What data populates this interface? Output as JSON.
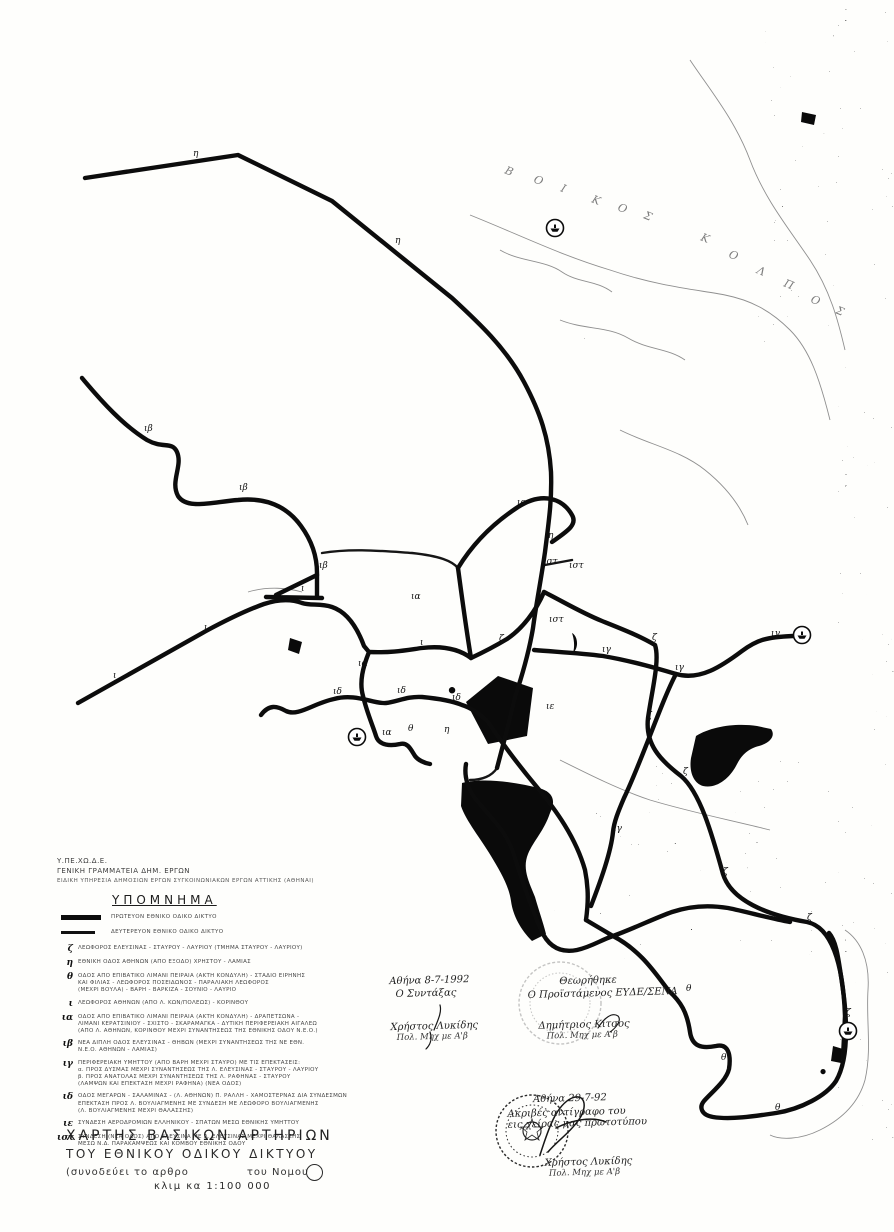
{
  "agency": {
    "line1": "Υ.ΠΕ.ΧΩ.Δ.Ε.",
    "line2": "ΓΕΝΙΚΗ ΓΡΑΜΜΑΤΕΙΑ ΔΗΜ. ΕΡΓΩΝ",
    "line3": "ΕΙΔΙΚΗ ΥΠΗΡΕΣΙΑ ΔΗΜΟΣΙΩΝ ΕΡΓΩΝ ΣΥΓΚΟΙΝΩΝΙΑΚΩΝ ΕΡΓΩΝ ΑΤΤΙΚΗΣ (ΑΘΗΝΑΙ)"
  },
  "legend": {
    "title": "ΥΠΟΜΝΗΜΑ",
    "line_items": [
      {
        "symbol": "thick-line",
        "label": "ΠΡΩΤΕΥΟΝ ΕΘΝΙΚΟ ΟΔΙΚΟ ΔΙΚΤΥΟ"
      },
      {
        "symbol": "medium-line",
        "label": "ΔΕΥΤΕΡΕΥΟΝ ΕΘΝΙΚΟ ΟΔΙΚΟ ΔΙΚΤΥΟ"
      }
    ],
    "entries": [
      {
        "key": "ζ",
        "lines": [
          "ΛΕΩΦΟΡΟΣ ΕΛΕΥΣΙΝΑΣ - ΣΤΑΥΡΟΥ - ΛΑΥΡΙΟΥ (ΤΜΗΜΑ ΣΤΑΥΡΟΥ - ΛΑΥΡΙΟΥ)"
        ]
      },
      {
        "key": "η",
        "lines": [
          "ΕΘΝΙΚΗ ΟΔΟΣ ΑΘΗΝΩΝ (ΑΠΟ ΕΞΟΔΟ) ΧΡΗΣΤΟΥ - ΛΑΜΙΑΣ"
        ]
      },
      {
        "key": "θ",
        "lines": [
          "ΟΔΟΣ ΑΠΟ ΕΠΙΒΑΤΙΚΟ ΛΙΜΑΝΙ ΠΕΙΡΑΙΑ (ΑΚΤΗ ΚΟΝΔΥΛΗ) - ΣΤΑΔΙΟ ΕΙΡΗΝΗΣ",
          "ΚΑΙ ΦΙΛΙΑΣ - ΛΕΩΦΟΡΟΣ ΠΟΣΕΙΔΩΝΟΣ - ΠΑΡΑΛΙΑΚΗ ΛΕΩΦΟΡΟΣ",
          "(ΜΕΧΡΙ ΒΟΥΛΑ) - ΒΑΡΗ - ΒΑΡΚΙΖΑ - ΣΟΥΝΙΟ - ΛΑΥΡΙΟ"
        ]
      },
      {
        "key": "ι",
        "lines": [
          "ΛΕΩΦΟΡΟΣ ΑΘΗΝΩΝ (ΑΠΟ Λ. ΚΩΝ/ΠΟΛΕΩΣ) - ΚΟΡΙΝΘΟΥ"
        ]
      },
      {
        "key": "ια",
        "lines": [
          "ΟΔΟΣ ΑΠΟ ΕΠΙΒΑΤΙΚΟ ΛΙΜΑΝΙ ΠΕΙΡΑΙΑ (ΑΚΤΗ ΚΟΝΔΥΛΗ) - ΔΡΑΠΕΤΣΩΝΑ -",
          "ΛΙΜΑΝΙ ΚΕΡΑΤΣΙΝΙΟΥ - ΣΧΙΣΤΟ - ΣΚΑΡΑΜΑΓΚΑ - ΔΥΤΙΚΗ ΠΕΡΙΦΕΡΕΙΑΚΗ ΑΙΓΑΛΕΩ",
          "(ΑΠΟ Λ. ΑΘΗΝΩΝ, ΚΟΡΙΝΘΟΥ ΜΕΧΡΙ ΣΥΝΑΝΤΗΣΕΩΣ ΤΗΣ ΕΘΝΙΚΗΣ ΟΔΟΥ Ν.Ε.Ο.)"
        ]
      },
      {
        "key": "ιβ",
        "lines": [
          "ΝΕΑ ΔΙΠΛΗ ΟΔΟΣ ΕΛΕΥΣΙΝΑΣ - ΘΗΒΩΝ (ΜΕΧΡΙ ΣΥΝΑΝΤΗΣΕΩΣ ΤΗΣ ΝΕ ΕΘΝ.",
          "Ν.Ε.Ο. ΑΘΗΝΩΝ - ΛΑΜΙΑΣ)"
        ]
      },
      {
        "key": "ιγ",
        "lines": [
          "ΠΕΡΙΦΕΡΕΙΑΚΗ ΥΜΗΤΤΟΥ (ΑΠΟ ΒΑΡΗ ΜΕΧΡΙ ΣΤΑΥΡΟ) ΜΕ ΤΙΣ ΕΠΕΚΤΑΣΕΙΣ:",
          "α. ΠΡΟΣ ΔΥΣΜΑΣ ΜΕΧΡΙ ΣΥΝΑΝΤΗΣΕΩΣ ΤΗΣ Λ. ΕΛΕΥΣΙΝΑΣ - ΣΤΑΥΡΟΥ - ΛΑΥΡΙΟΥ",
          "β. ΠΡΟΣ ΑΝΑΤΟΛΑΣ ΜΕΧΡΙ ΣΥΝΑΝΤΗΣΕΩΣ ΤΗΣ Λ. ΡΑΦΗΝΑΣ - ΣΤΑΥΡΟΥ",
          "(ΛΑΜΨΩΝ ΚΑΙ ΕΠΕΚΤΑΣΗ ΜΕΧΡΙ ΡΑΦΗΝΑ) (ΝΕΑ ΟΔΟΣ)"
        ]
      },
      {
        "key": "ιδ",
        "lines": [
          "ΟΔΟΣ ΜΕΓΑΡΩΝ - ΣΑΛΑΜΙΝΑΣ - (Λ. ΑΘΗΝΩΝ) Π. ΡΑΛΛΗ - ΧΑΜΟΣΤΕΡΝΑΣ ΔΙΑ ΣΥΝΔΕΣΜΩΝ",
          "ΕΠΕΚΤΑΣΗ ΠΡΟΣ Λ. ΒΟΥΛΙΑΓΜΕΝΗΣ ΜΕ ΣΥΝΔΕΣΗ ΜΕ ΛΕΩΦΟΡΟ ΒΟΥΛΙΑΓΜΕΝΗΣ",
          "(Λ. ΒΟΥΛΙΑΓΜΕΝΗΣ ΜΕΧΡΙ ΘΑΛΑΣΣΗΣ)"
        ]
      },
      {
        "key": "ιε",
        "lines": [
          "ΣΥΝΔΕΣΗ ΑΕΡΟΔΡΟΜΙΩΝ ΕΛΛΗΝΙΚΟΥ - ΣΠΑΤΩΝ ΜΕΣΩ ΕΘΝΙΚΗΣ ΥΜΗΤΤΟΥ"
        ]
      },
      {
        "key": "ιστ",
        "lines": [
          "ΣΥΝΔΕΣΗ (ΝΕΑ ΟΔΟΣ) ΑΠΟ ΕΛΕΥΣΙΝΑ ΜΕ Λ. ΕΛΕΥΣΙΝΑΣ ΜΕΧΡΙ ΘΑΛΑΣΣΗΣ",
          "ΜΕΣΩ Ν.Δ. ΠΑΡΑΚΑΜΨΕΩΣ ΚΑΙ ΚΟΜΒΟΥ ΕΘΝΙΚΗΣ ΟΔΟΥ"
        ]
      }
    ]
  },
  "title_block": {
    "line1": "ΧΑΡΤΗΣ  ΒΑΣΙΚΩΝ  ΑΡΤΗΡΙΩΝ",
    "line2": "ΤΟΥ ΕΘΝΙΚΟΥ  ΟΔΙΚΟΥ  ΔΙΚΤΥΟΥ",
    "line3a": "(συνοδεύει  το  αρθρο",
    "line3b": "του  Νομου",
    "line4": "κλιμ κα 1:100 000"
  },
  "signatures": {
    "left": {
      "date": "Αθήνα 8-7-1992",
      "role": "Ο Συντάξας",
      "name": "Χρήστος Λυκίδης",
      "title": "Πολ. Μηχ με Α'β"
    },
    "right": {
      "approved": "Θεωρήθηκε",
      "role": "Ο Προϊστάμενος ΕΥΔΕ/ΣΕΝΑ",
      "name": "Δημήτριος Κίτσος",
      "title": "Πολ. Μηχ με Α'β"
    },
    "bottom": {
      "date": "Αθήνα 29-7-92",
      "note1": "Ακριβές αντίγραφο του",
      "note2": "εις χείρας μας πρωτοτύπου",
      "name": "Χρήστος Λυκίδης",
      "title": "Πολ. Μηχ με Α'β"
    }
  },
  "map": {
    "sea_label": {
      "text": "ΕΥΒΟΙΚΟΣ ΚΟΛΠΟΣ",
      "letters": [
        {
          "ch": "Β",
          "x": 504,
          "y": 173
        },
        {
          "ch": "Ο",
          "x": 533,
          "y": 182
        },
        {
          "ch": "Ι",
          "x": 560,
          "y": 191
        },
        {
          "ch": "Κ",
          "x": 591,
          "y": 202
        },
        {
          "ch": "Ο",
          "x": 617,
          "y": 210
        },
        {
          "ch": "Σ",
          "x": 643,
          "y": 218
        },
        {
          "ch": "Κ",
          "x": 700,
          "y": 240
        },
        {
          "ch": "Ο",
          "x": 728,
          "y": 257
        },
        {
          "ch": "Λ",
          "x": 756,
          "y": 273
        },
        {
          "ch": "Π",
          "x": 783,
          "y": 286
        },
        {
          "ch": "Ο",
          "x": 810,
          "y": 302
        },
        {
          "ch": "Σ",
          "x": 835,
          "y": 313
        }
      ]
    },
    "road_labels": [
      {
        "t": "η",
        "x": 193,
        "y": 156
      },
      {
        "t": "η",
        "x": 395,
        "y": 243
      },
      {
        "t": "η",
        "x": 548,
        "y": 538
      },
      {
        "t": "η",
        "x": 444,
        "y": 732
      },
      {
        "t": "ιβ",
        "x": 144,
        "y": 431
      },
      {
        "t": "ιβ",
        "x": 239,
        "y": 490
      },
      {
        "t": "ιβ",
        "x": 319,
        "y": 568
      },
      {
        "t": "ι",
        "x": 113,
        "y": 678
      },
      {
        "t": "ι",
        "x": 204,
        "y": 630
      },
      {
        "t": "ι",
        "x": 301,
        "y": 591
      },
      {
        "t": "ι",
        "x": 420,
        "y": 645
      },
      {
        "t": "ια",
        "x": 517,
        "y": 505
      },
      {
        "t": "ια",
        "x": 411,
        "y": 599
      },
      {
        "t": "ια",
        "x": 358,
        "y": 666
      },
      {
        "t": "ια",
        "x": 382,
        "y": 735
      },
      {
        "t": "ιδ",
        "x": 333,
        "y": 694
      },
      {
        "t": "ιδ",
        "x": 397,
        "y": 693
      },
      {
        "t": "ιδ",
        "x": 452,
        "y": 700
      },
      {
        "t": "ιε",
        "x": 546,
        "y": 709
      },
      {
        "t": "ιστ",
        "x": 543,
        "y": 564
      },
      {
        "t": "ιστ",
        "x": 569,
        "y": 568
      },
      {
        "t": "ιστ",
        "x": 549,
        "y": 622
      },
      {
        "t": "ζ",
        "x": 499,
        "y": 641
      },
      {
        "t": "ζ",
        "x": 652,
        "y": 640
      },
      {
        "t": "ζ",
        "x": 647,
        "y": 718
      },
      {
        "t": "ζ",
        "x": 683,
        "y": 774
      },
      {
        "t": "ζ",
        "x": 723,
        "y": 874
      },
      {
        "t": "ζ",
        "x": 807,
        "y": 920
      },
      {
        "t": "ζ",
        "x": 846,
        "y": 1015
      },
      {
        "t": "ιγ",
        "x": 602,
        "y": 652
      },
      {
        "t": "ιγ",
        "x": 675,
        "y": 670
      },
      {
        "t": "ιγ",
        "x": 771,
        "y": 636
      },
      {
        "t": "ιγ",
        "x": 613,
        "y": 831
      },
      {
        "t": "θ",
        "x": 408,
        "y": 731
      },
      {
        "t": "θ",
        "x": 686,
        "y": 991
      },
      {
        "t": "θ",
        "x": 721,
        "y": 1060
      },
      {
        "t": "θ",
        "x": 775,
        "y": 1110
      }
    ],
    "ports": [
      {
        "x": 555,
        "y": 228
      },
      {
        "x": 357,
        "y": 737
      },
      {
        "x": 802,
        "y": 635
      },
      {
        "x": 848,
        "y": 1031
      }
    ],
    "roads": {
      "primary": [
        "M85,178 L238,155 L332,201 L452,298 C478,322 506,348 524,382 C540,412 549,438 551,472 C552,500 549,520 545,552 C541,580 536,605 533,628 C529,652 522,676 515,697 C510,718 504,742 497,768",
        "M82,378 C102,402 124,426 147,440 C163,449 172,441 177,452 C183,466 170,481 178,496 C187,510 212,502 238,500 C268,497 288,508 301,526 C312,541 317,556 317,573 L317,597",
        "M317,575 L276,595 M266,597 L322,598",
        "M78,703 L206,631 C232,617 250,609 264,604 C282,598 294,600 302,603 C311,606 320,603 332,607 C347,612 357,627 364,646 L369,652",
        "M369,652 C392,653 407,650 422,648 C448,645 463,652 471,658",
        "M458,568 C472,545 492,524 518,507 C543,491 563,499 572,515 C578,525 566,532 552,542",
        "M458,568 C462,598 466,628 471,658",
        "M471,658 C486,651 497,645 507,639 C522,629 536,611 544,592",
        "M544,592 C562,601 582,613 602,621 C622,629 640,636 655,645 C660,660 652,690 648,718 C645,744 660,760 681,776 C700,792 712,834 723,874 C731,900 766,915 807,922 C831,927 843,962 845,1016 L843,1058",
        "M534,650 C558,652 580,653 603,656 C632,661 656,668 676,674 C700,681 722,666 742,651 C757,640 766,637 793,636",
        "M676,674 C662,700 643,758 624,798 C618,812 614,822 613,832 C611,852 601,880 591,906",
        "M261,715 C269,704 277,706 286,711 C298,717 314,703 334,699 C356,693 373,704 386,703 C397,702 407,696 422,697 C443,699 455,702 462,705 C472,708 480,714 488,722",
        "M369,652 C363,667 359,682 363,696 C367,713 373,726 376,736 C379,746 391,746 400,744 C408,742 411,750 415,756 C418,760 424,763 430,764",
        "M466,764 C464,775 467,786 474,797 C490,817 506,831 513,852 C521,877 529,902 541,930 C549,948 562,953 577,950 C591,947 601,940 613,936",
        "M488,722 C500,740 516,762 536,786 C556,810 576,838 585,870 C589,890 588,905 586,920",
        "M586,920 L613,936",
        "M613,936 C642,951 657,976 669,991 C681,1002 687,1012 690,1032 C692,1046 701,1049 716,1046 C729,1043 731,1056 729,1069 C726,1081 713,1091 704,1101 C699,1107 701,1115 713,1117 C731,1120 756,1116 776,1113 C801,1109 826,1096 836,1081 C843,1069 846,1051 846,1031 C846,1011 844,996 841,976 C838,956 836,941 829,933",
        "M613,936 C635,928 655,918 672,912 C690,906 710,905 728,908 C748,912 768,918 790,922"
      ],
      "medium": [
        "M322,553 C352,548 382,551 412,553 C440,556 452,561 458,568",
        "M497,768 C492,776 482,780 470,780",
        "M545,565 L572,560"
      ],
      "thin": [
        "M470,215 C520,235 560,255 610,270 C660,287 700,290 725,295 C750,300 770,310 790,330 C810,350 820,380 830,420",
        "M690,60 C710,90 735,120 750,160 C765,200 790,230 810,260 C830,290 838,320 845,350",
        "M845,930 C860,940 870,960 868,990 C866,1020 872,1050 865,1080 C858,1105 840,1120 820,1130 C800,1140 780,1140 770,1135",
        "M500,250 C520,262 545,260 562,272 C578,283 596,280 612,292",
        "M560,320 C585,330 608,326 628,338 C648,350 668,348 685,360",
        "M620,430 C650,445 680,450 705,470 C725,486 740,505 748,525",
        "M560,760 C590,775 620,790 650,800 C690,812 730,820 770,830",
        "M248,592 C268,586 288,588 302,592"
      ]
    },
    "urban": [
      "M466,702 L498,676 L533,688 L527,736 L488,744 Z",
      "M462,783 C482,778 512,781 542,789 C553,793 556,801 550,813 C544,831 534,840 528,854 C522,869 529,882 535,897 C539,911 543,922 546,934 L532,941 C521,930 513,916 511,901 C509,886 500,871 491,856 C481,839 466,821 461,806 Z",
      "M696,736 C712,726 737,723 757,726 L771,729 C776,736 770,743 759,746 C747,749 741,756 736,766 C729,779 716,789 703,786 C693,783 689,771 691,758 Z",
      "M290,638 L302,642 L299,654 L288,650 Z",
      "M572,633 C578,636 579,648 573,653 C575,646 574,639 572,633 Z",
      "M452,687 a3.2,3.2 0 1 0 0.1,0 Z",
      "M833,1046 L843,1049 L841,1063 L831,1061 Z",
      "M823,1069 a2.6,2.6 0 1 0 0.1,0 Z",
      "M802,112 L816,115 L814,125 L801,122 Z"
    ]
  }
}
